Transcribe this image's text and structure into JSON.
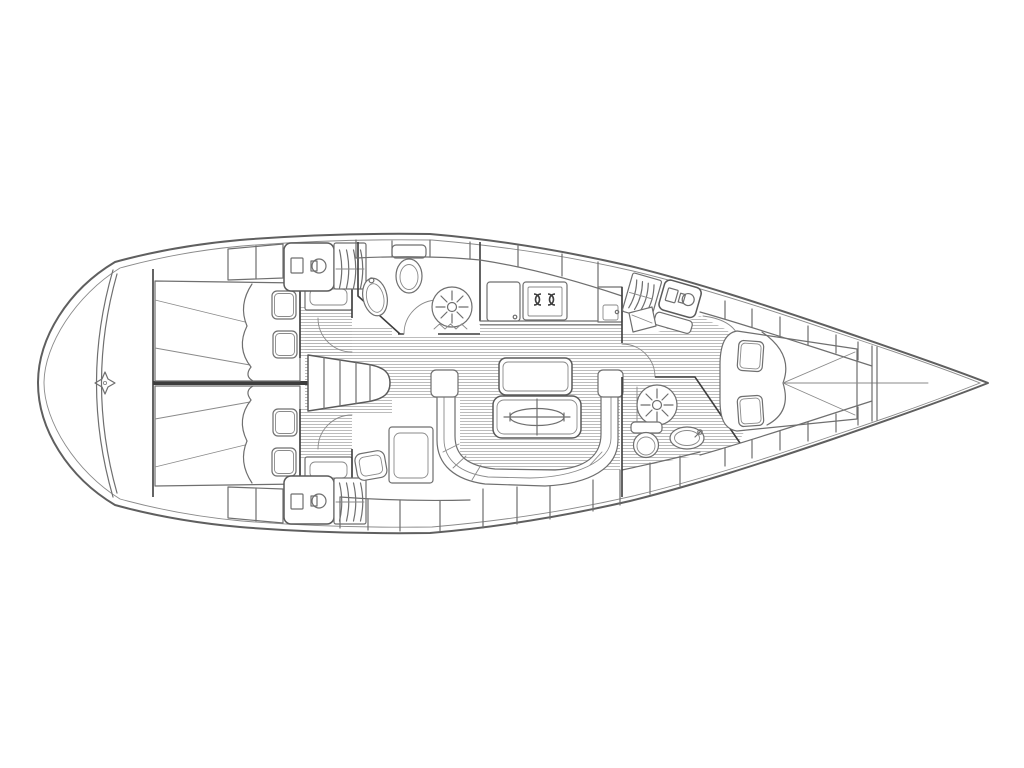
{
  "diagram": {
    "title": "Sailing yacht interior layout floor plan",
    "orientation": {
      "bow": "right",
      "stern": "left"
    },
    "colors": {
      "background": "#ffffff",
      "line": "#6f6f6f",
      "line_dark": "#3d3d3d",
      "floor_hatch": "#b5b5b5",
      "fill": "#ffffff"
    },
    "rooms": [
      {
        "label": "stern lazarette"
      },
      {
        "label": "aft cabin port with double berth"
      },
      {
        "label": "aft cabin starboard with double berth"
      },
      {
        "label": "companionway steps"
      },
      {
        "label": "aft head with toilet, washbasin and shower"
      },
      {
        "label": "galley with stove, fridge and lockers"
      },
      {
        "label": "saloon with U-shaped settee and table"
      },
      {
        "label": "navigation station"
      },
      {
        "label": "forward head with shower, toilet and washbasin"
      },
      {
        "label": "forward cabin with V-berth"
      },
      {
        "label": "bow anchor locker"
      }
    ],
    "fixtures": [
      {
        "name": "rudder-post-icon"
      },
      {
        "name": "washbasin-cabinet-icon"
      },
      {
        "name": "hanging-locker-icon"
      },
      {
        "name": "toilet-icon"
      },
      {
        "name": "oval-sink-icon"
      },
      {
        "name": "shower-rose-icon"
      },
      {
        "name": "two-burner-stove-icon"
      },
      {
        "name": "fridge-door-icon"
      },
      {
        "name": "saloon-table-leaf-icon"
      },
      {
        "name": "pillow-icon"
      },
      {
        "name": "companionway-steps-icon"
      }
    ]
  }
}
